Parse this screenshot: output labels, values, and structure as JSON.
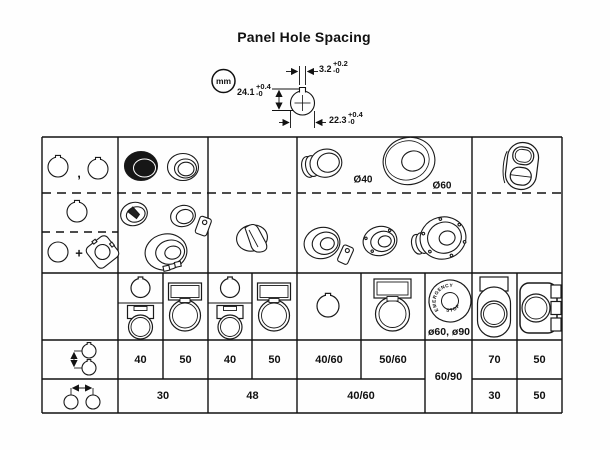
{
  "title": "Panel Hole Spacing",
  "unit_badge": "mm",
  "hole_dimensions": {
    "notch_width": {
      "value": "3.2",
      "tol_plus": "+0.2",
      "tol_minus": "-0"
    },
    "total_height": {
      "value": "24.1",
      "tol_plus": "+0.4",
      "tol_minus": "-0"
    },
    "diameter": {
      "value": "22.3",
      "tol_plus": "+0.4",
      "tol_minus": "-0"
    }
  },
  "labels": {
    "mushroom_40": "Ø40",
    "mushroom_60": "Ø60",
    "estop_line1": "EMERGENCY",
    "estop_line2": "STOP",
    "estop_sizes": "ø60, ø90",
    "comma": ",",
    "plus": "+"
  },
  "spacing": {
    "vertical": [
      "40",
      "50",
      "40",
      "50",
      "40/60",
      "50/60",
      "70",
      "50"
    ],
    "vertical_merged": "60/90",
    "horizontal": [
      "30",
      "48",
      "40/60",
      "30",
      "50"
    ]
  }
}
